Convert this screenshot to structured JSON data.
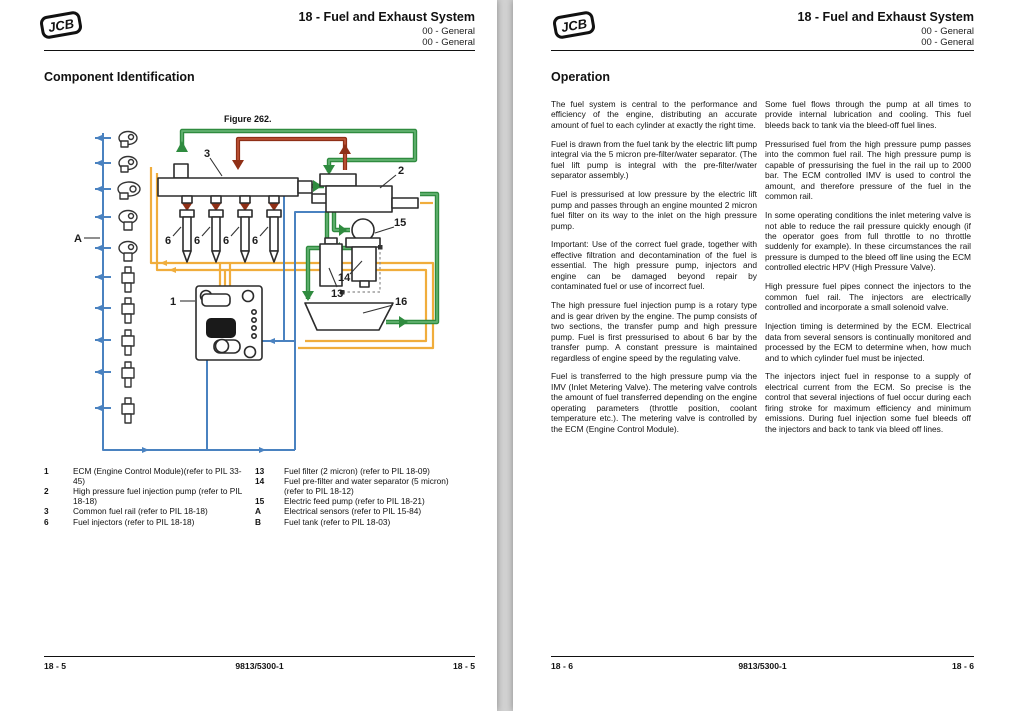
{
  "page_left": {
    "header": {
      "logo": "JCB",
      "section": "18 - Fuel and Exhaust System",
      "sub1": "00 - General",
      "sub2": "00 - General"
    },
    "heading": "Component Identification",
    "figure_caption": "Figure 262.",
    "legend": {
      "col1": [
        {
          "num": "1",
          "text": "ECM (Engine Control Module)(refer to PIL 33-45)"
        },
        {
          "num": "2",
          "text": "High pressure fuel injection pump (refer to PIL 18-18)"
        },
        {
          "num": "3",
          "text": "Common fuel rail (refer to PIL 18-18)"
        },
        {
          "num": "6",
          "text": "Fuel injectors (refer to PIL 18-18)"
        }
      ],
      "col2": [
        {
          "num": "13",
          "text": "Fuel filter (2 micron) (refer to PIL 18-09)"
        },
        {
          "num": "14",
          "text": "Fuel pre-filter and water separator (5 micron) (refer to PIL 18-12)"
        },
        {
          "num": "15",
          "text": "Electric feed pump (refer to PIL 18-21)"
        },
        {
          "num": "A",
          "text": "Electrical sensors (refer to PIL 15-84)"
        },
        {
          "num": "B",
          "text": "Fuel tank (refer to PIL 18-03)"
        }
      ]
    },
    "footer": {
      "left": "18 - 5",
      "center": "9813/5300-1",
      "right": "18 - 5"
    }
  },
  "page_right": {
    "header": {
      "logo": "JCB",
      "section": "18 - Fuel and Exhaust System",
      "sub1": "00 - General",
      "sub2": "00 - General"
    },
    "heading": "Operation",
    "col1": [
      "The fuel system is central to the performance and efficiency of the engine, distributing an accurate amount of fuel to each cylinder at exactly the right time.",
      "Fuel is drawn from the fuel tank by the electric lift pump integral via the 5 micron pre-filter/water separator. (The fuel lift pump is integral with the pre-filter/water separator assembly.)",
      "Fuel is pressurised at low pressure by the electric lift pump and passes through an engine mounted 2 micron fuel filter on its way to the inlet on the high pressure pump.",
      "Important: Use of the correct fuel grade, together with effective filtration and decontamination of the fuel is essential. The high pressure pump, injectors and engine can be damaged beyond repair by contaminated fuel or use of incorrect fuel.",
      "The high pressure fuel injection pump is a rotary type and is gear driven by the engine. The pump consists of two sections, the transfer pump and high pressure pump. Fuel is first pressurised to about 6 bar by the transfer pump. A constant pressure is maintained regardless of engine speed by the regulating valve.",
      "Fuel is transferred to the high pressure pump via the IMV (Inlet Metering Valve). The metering valve controls the amount of fuel transferred depending on the engine operating parameters (throttle position, coolant temperature etc.). The metering valve is controlled by the ECM (Engine Control Module)."
    ],
    "col2": [
      "Some fuel flows through the pump at all times to provide internal lubrication and cooling. This fuel bleeds back to tank via the bleed-off fuel lines.",
      "Pressurised fuel from the high pressure pump passes into the common fuel rail. The high pressure pump is capable of pressurising the fuel in the rail up to 2000 bar. The ECM controlled IMV is used to control the amount, and therefore pressure of the fuel in the common rail.",
      "In some operating conditions the inlet metering valve is not able to reduce the rail pressure quickly enough (if the operator goes from full throttle to no throttle suddenly for example). In these circumstances the rail pressure is dumped to the bleed off line using the ECM controlled electric HPV (High Pressure Valve).",
      "High pressure fuel pipes connect the injectors to the common fuel rail. The injectors are electrically controlled and incorporate a small solenoid valve.",
      "Injection timing is determined by the ECM. Electrical data from several sensors is continually monitored and processed by the ECM to determine when, how much and to which cylinder fuel must be injected.",
      "The injectors inject fuel in response to a supply of electrical current from the ECM. So precise is the control that several injections of fuel occur during each firing stroke for maximum efficiency and minimum emissions. During fuel injection some fuel bleeds off the injectors and back to tank via bleed off lines."
    ],
    "footer": {
      "left": "18 - 6",
      "center": "9813/5300-1",
      "right": "18 - 6"
    }
  },
  "diagram": {
    "labels": {
      "a": "A",
      "n1": "1",
      "n2": "2",
      "n3": "3",
      "n6": "6",
      "n13": "13",
      "n14": "14",
      "n15": "15",
      "n16": "16"
    },
    "colors": {
      "green": "#2f8b3f",
      "green_light": "#63b271",
      "red": "#8f2f16",
      "red_light": "#c0563a",
      "orange": "#f0ad3c",
      "blue": "#4a82c0",
      "outline": "#2b2b2b",
      "dash": "#8a8a8a",
      "label": "#1d1d1d"
    }
  }
}
